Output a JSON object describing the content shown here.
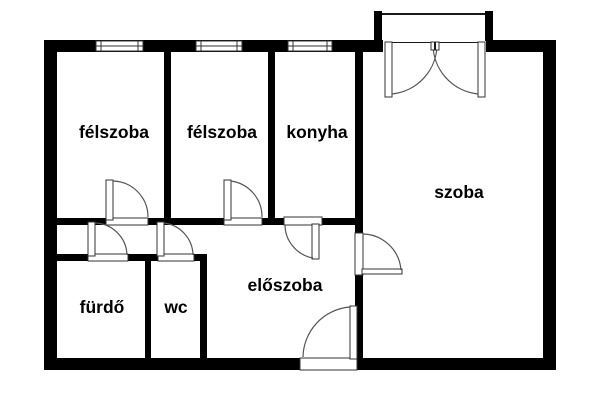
{
  "floor_plan": {
    "background_color": "#ffffff",
    "wall_color": "#000000",
    "line_color": "#555555",
    "rooms": [
      {
        "id": "felszoba-1",
        "label": "félszoba"
      },
      {
        "id": "felszoba-2",
        "label": "félszoba"
      },
      {
        "id": "konyha",
        "label": "konyha"
      },
      {
        "id": "szoba",
        "label": "szoba"
      },
      {
        "id": "eloszoba",
        "label": "előszoba"
      },
      {
        "id": "furdo",
        "label": "fürdő"
      },
      {
        "id": "wc",
        "label": "wc"
      }
    ],
    "features": {
      "windows_on_top_wall": 3,
      "balcony": true,
      "single_doors": 7,
      "double_door_to_balcony": 1
    }
  }
}
